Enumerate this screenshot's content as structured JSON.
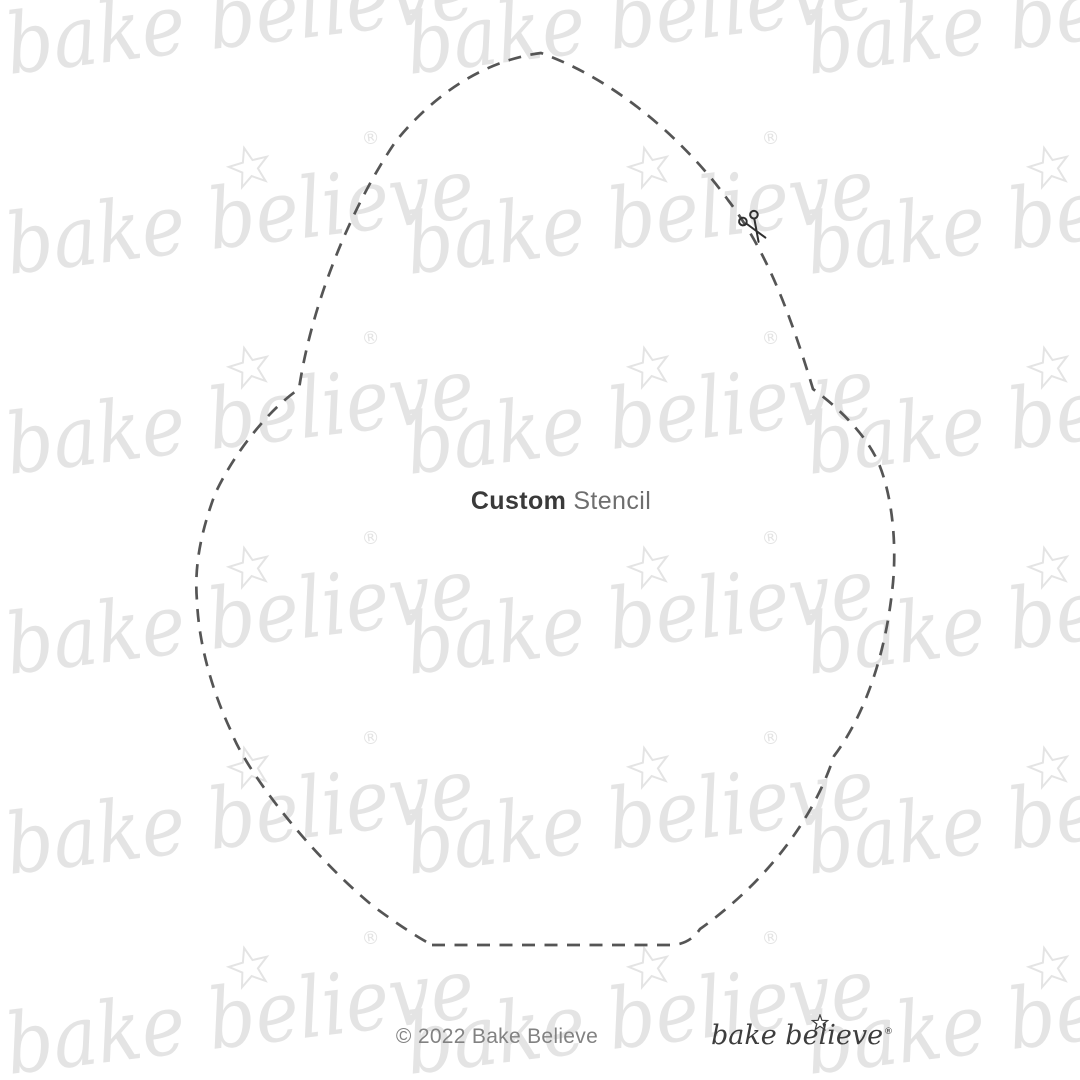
{
  "title": {
    "bold": "Custom",
    "regular": "Stencil"
  },
  "footer": {
    "copyright": "© 2022 Bake Believe"
  },
  "logo": {
    "text": "bake believe",
    "reg_mark": "®"
  },
  "watermark": {
    "text": "bake believe",
    "reg_mark": "®",
    "color": "#e4e4e4",
    "rows": 6,
    "cols": 3
  },
  "colors": {
    "background": "#ffffff",
    "watermark_gray": "#e4e4e4",
    "cut_line": "#555555",
    "title_bold": "#3a3a3a",
    "title_regular": "#6e6e6e",
    "copyright_gray": "#828282",
    "logo_dark": "#3d3d3d"
  }
}
